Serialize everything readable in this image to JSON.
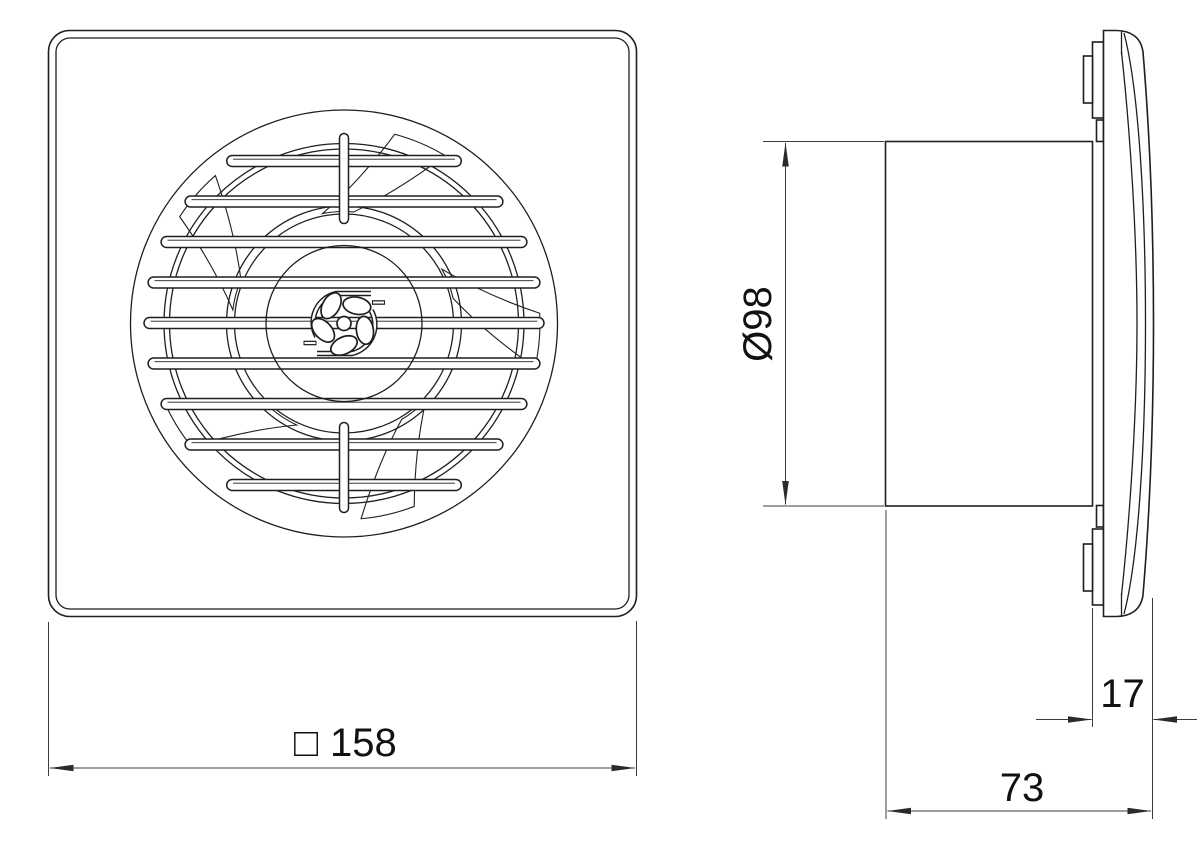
{
  "drawing": {
    "type": "technical-drawing-extractor-fan",
    "views": [
      "front-view",
      "side-profile-view"
    ],
    "colors": {
      "background": "#ffffff",
      "object_line": "#1f1f1f",
      "dimension_line": "#3c3c3c",
      "text": "#111111"
    },
    "dimensions": {
      "front_square": {
        "symbol": "□",
        "value": "158"
      },
      "duct_diameter": {
        "value": "Ø98"
      },
      "front_depth": {
        "value": "17"
      },
      "rear_depth": {
        "value": "73"
      }
    }
  }
}
